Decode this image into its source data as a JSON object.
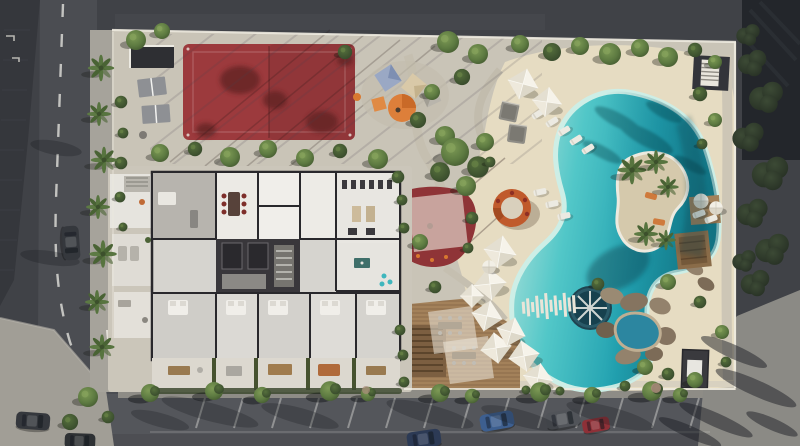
{
  "image": {
    "kind": "aerial-architectural-render",
    "description": "Photorealistic top-down rendering of a residential resort block: red sports court, furnished apartment floor plan, landscaped garden, free-form turquoise lagoon pool with palm island and round sunken deck, sandy beach with white parasols, timber dining deck, rock grotto spa, surrounded by roads with parked cars and street trees",
    "width_px": 800,
    "height_px": 446
  },
  "palette": {
    "asphalt": "#404247",
    "roof-dark": "#35373c",
    "road": "#4b4d52",
    "street": "#54565b",
    "sidewalk": "#a19e96",
    "pavement": "#8b8a85",
    "parcel": "#c9c4b7",
    "sand": "#e6dcc2",
    "wall-white": "#edeadf",
    "road-marking": "#d8d8d4",
    "court-red": "#9c3a3d",
    "playground-red": "#8f3437",
    "shade-sail": "#ece8dc",
    "pool-shallow": "#c8ece4",
    "pool-mid": "#45c2c6",
    "pool-deep": "#1b96a6",
    "pool-shadow": "#0f7488",
    "wheel-teal": "#2a5a68",
    "island-sand": "#d5c9ac",
    "tree-green": "#5d7a41",
    "tree-dark": "#3f5530",
    "tree-light": "#7d9a55",
    "hedge-outer": "#2f3a2c",
    "deck-wood": "#a3815a",
    "pergola-wood": "#7c5f41",
    "rock": "#93826c",
    "umbrella-white": "#f2efe6",
    "canopy-orange": "#dd7f3a",
    "canopy-blue": "#9aa8c4",
    "lounge-orange": "#c05a2c",
    "floor-wall": "#29282c",
    "floor-room": "#e9e7e2",
    "floor-core": "#39373b",
    "car-blue": "#3d5f90",
    "car-red": "#8e3037",
    "car-dark": "#35383d",
    "car-navy": "#2c3a55"
  },
  "scene": {
    "features": [
      {
        "name": "left-road",
        "desc": "vertical two-lane road with dashed centre line and one parked dark car, dark tiled roof on its left"
      },
      {
        "name": "sports-court",
        "desc": "dark-red multi-sport court with tree shadows and diagonal paving joint shadows"
      },
      {
        "name": "table-tennis-area",
        "desc": "two grey table-tennis tables beside a small dark pavilion"
      },
      {
        "name": "kids-playground",
        "desc": "play structure with orange, blue and tan shade canopies among winding garden paths"
      },
      {
        "name": "apartment-floorplan",
        "desc": "furnished top-down floor plan: grey and white rooms, dark elevator core, gym with equipment, beds, dining set, private terraces with hedges"
      },
      {
        "name": "shaded-playground",
        "desc": "red rubber playground under a translucent shade sail"
      },
      {
        "name": "fire-pit-lounge",
        "desc": "circular terracotta sunken lounge on the sand"
      },
      {
        "name": "lagoon-pool",
        "desc": "free-form turquoise lagoon, palm island, white slat bridge, round teal sunken deck with radial spokes"
      },
      {
        "name": "beach-amenities",
        "desc": "white pyramid parasols, grey canopy daybeds and rows of sun loungers on sand"
      },
      {
        "name": "dining-deck",
        "desc": "timber deck with slatted pergola and tables under translucent sails"
      },
      {
        "name": "rock-grotto-spa",
        "desc": "natural rock cluster with a small blue spa pool"
      },
      {
        "name": "pool-shed",
        "desc": "small dark flat-roof structure near the south-east corner"
      },
      {
        "name": "street-parking",
        "desc": "angled parking along the bottom street with blue, grey, red and navy cars between street trees"
      },
      {
        "name": "outer-edges",
        "desc": "dark asphalt and dense dark hedges beyond the white perimeter wall, light pavement with palm shadows at the south-east corner"
      }
    ]
  }
}
